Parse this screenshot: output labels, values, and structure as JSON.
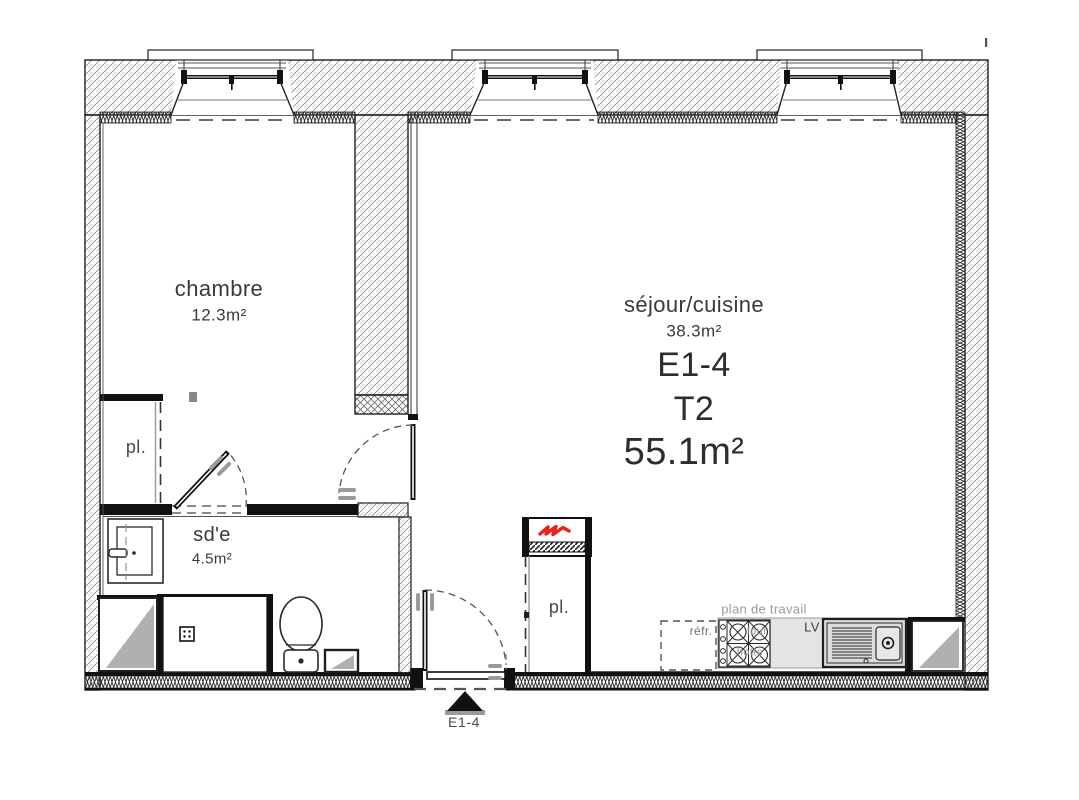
{
  "plan": {
    "unit": {
      "code": "E1-4",
      "type": "T2",
      "area": "55.1m²"
    },
    "rooms": [
      {
        "id": "chambre",
        "label": "chambre",
        "area": "12.3m²"
      },
      {
        "id": "sejour_cuisine",
        "label": "séjour/cuisine",
        "area": "38.3m²"
      },
      {
        "id": "salle_eau",
        "label": "sd'e",
        "area": "4.5m²"
      }
    ],
    "closets": [
      {
        "label": "pl."
      },
      {
        "label": "pl."
      }
    ],
    "kitchen": {
      "counter_label": "plan de travail",
      "fridge_label": "réfr.",
      "oven_label": "four",
      "hood_label": "hotte",
      "dishwasher_label": "LV"
    },
    "entry": {
      "door_label": "E1-4"
    },
    "colors": {
      "line": "#1f1f1f",
      "hatch": "#8f8f8f",
      "text": "#3a3a3a",
      "muted_text": "#9b9b9b",
      "accent_red": "#e8211d",
      "shaft_gray": "#b0b0b0",
      "counter_gray": "#e4e4e4"
    }
  }
}
